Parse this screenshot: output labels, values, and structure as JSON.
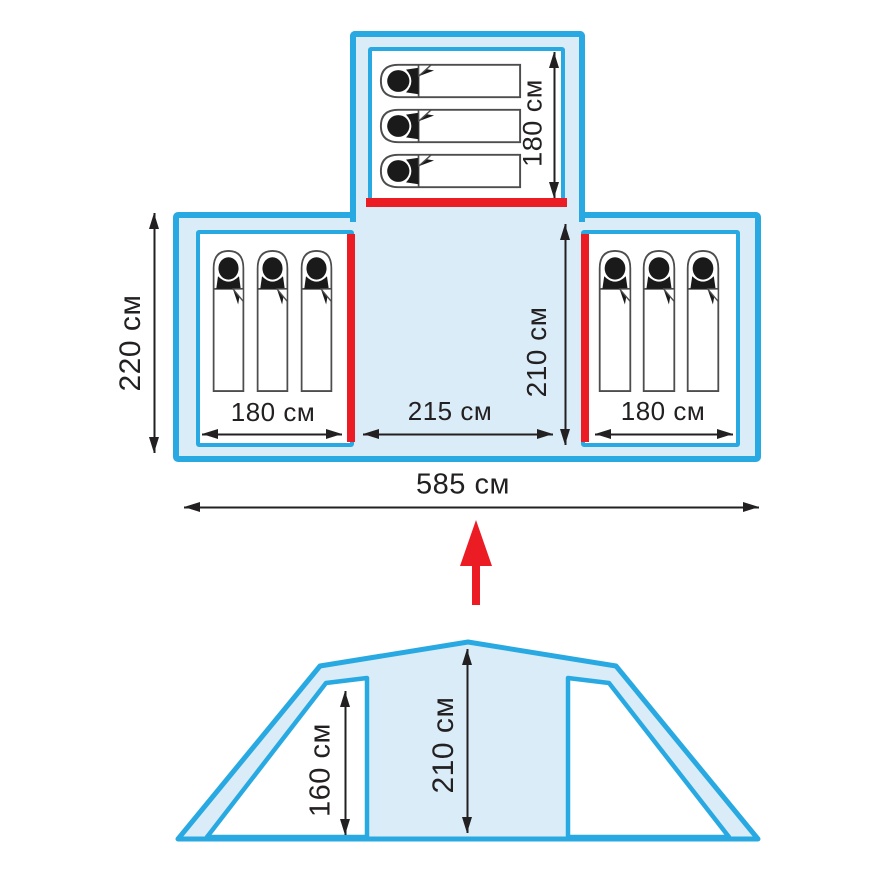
{
  "plan": {
    "left_room_width_label": "180 см",
    "center_width_label": "215 см",
    "right_room_width_label": "180 см",
    "total_width_label": "585 см",
    "outer_depth_label": "220 см",
    "center_depth_label": "210 см",
    "top_room_length_label": "180 см",
    "sleeping_spots_per_room": 3
  },
  "elevation": {
    "side_height_label": "160 см",
    "center_height_label": "210 см"
  },
  "colors": {
    "outline_cyan": "#29A9E1",
    "interior_fill": "#DAECF8",
    "entrance_red": "#EB1C24",
    "ink": "#232021",
    "bag_outline": "#4D4D4D"
  },
  "icons": {
    "sleeper": "sleeping-bag-person-icon",
    "direction_arrow": "up-arrow-icon",
    "dimension_arrow": "double-headed-arrow-icon"
  }
}
